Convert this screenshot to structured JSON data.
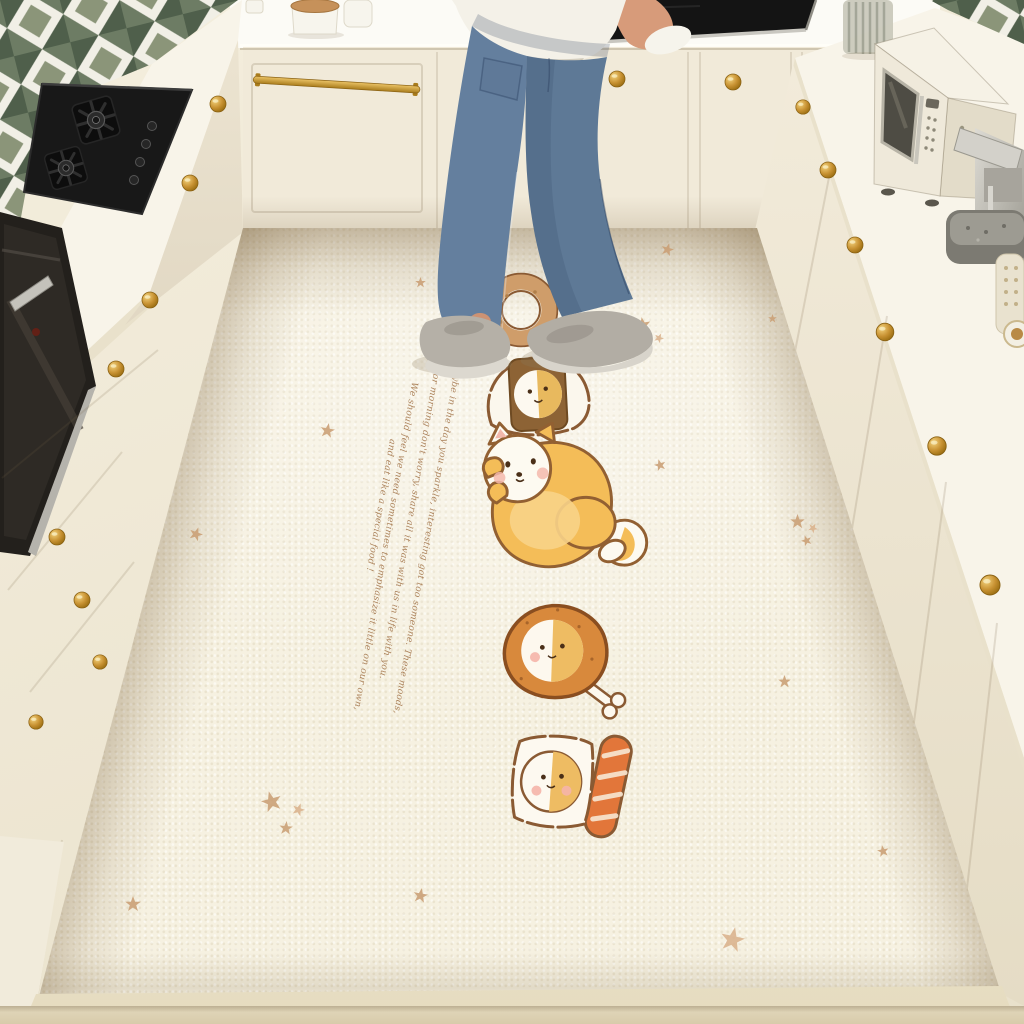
{
  "scene": {
    "name": "kitchen-with-cartoon-floor-mat",
    "objects": [
      "tile-backsplash",
      "gas-cooktop",
      "built-in-oven",
      "cream-cabinets",
      "gold-knobs",
      "black-sink",
      "person-standing",
      "microwave",
      "coffee-machine",
      "glass-jar",
      "canisters",
      "cartoon-floor-mat"
    ]
  },
  "mat": {
    "base_color": "#f6f1e1",
    "star_color": "#c99e74",
    "text_color": "#a5784e",
    "text_lines": [
      "Maybe in the day you sparkle, interesting got too someone. These moods,",
      "for morning don't worry, share all it was with us in life with you.",
      "We should feel we need sometimes to emphasize it little on our own,",
      "and eat like a special food !"
    ],
    "illustrations": [
      "donut",
      "rice-ball",
      "shiba-dog",
      "chicken-drumstick",
      "salmon-sushi"
    ]
  },
  "palette": {
    "cabinet_cream": "#f0e9d8",
    "counter_white": "#f8f4e9",
    "wall_white": "#fcfbf6",
    "gold": "#c08a2e",
    "tile_green": "#5e6e59",
    "appliance_black": "#1c1a17",
    "steel": "#bdbbb4",
    "jeans_blue": "#5e7996",
    "shirt_white": "#f4f1e8",
    "skin": "#d79b7a",
    "shoe_gray": "#b5b0a7",
    "floor_beige": "#d8cbab",
    "mat_base": "#f6f1e1",
    "star_color": "#c99e74",
    "mat_text": "#a5784e"
  }
}
